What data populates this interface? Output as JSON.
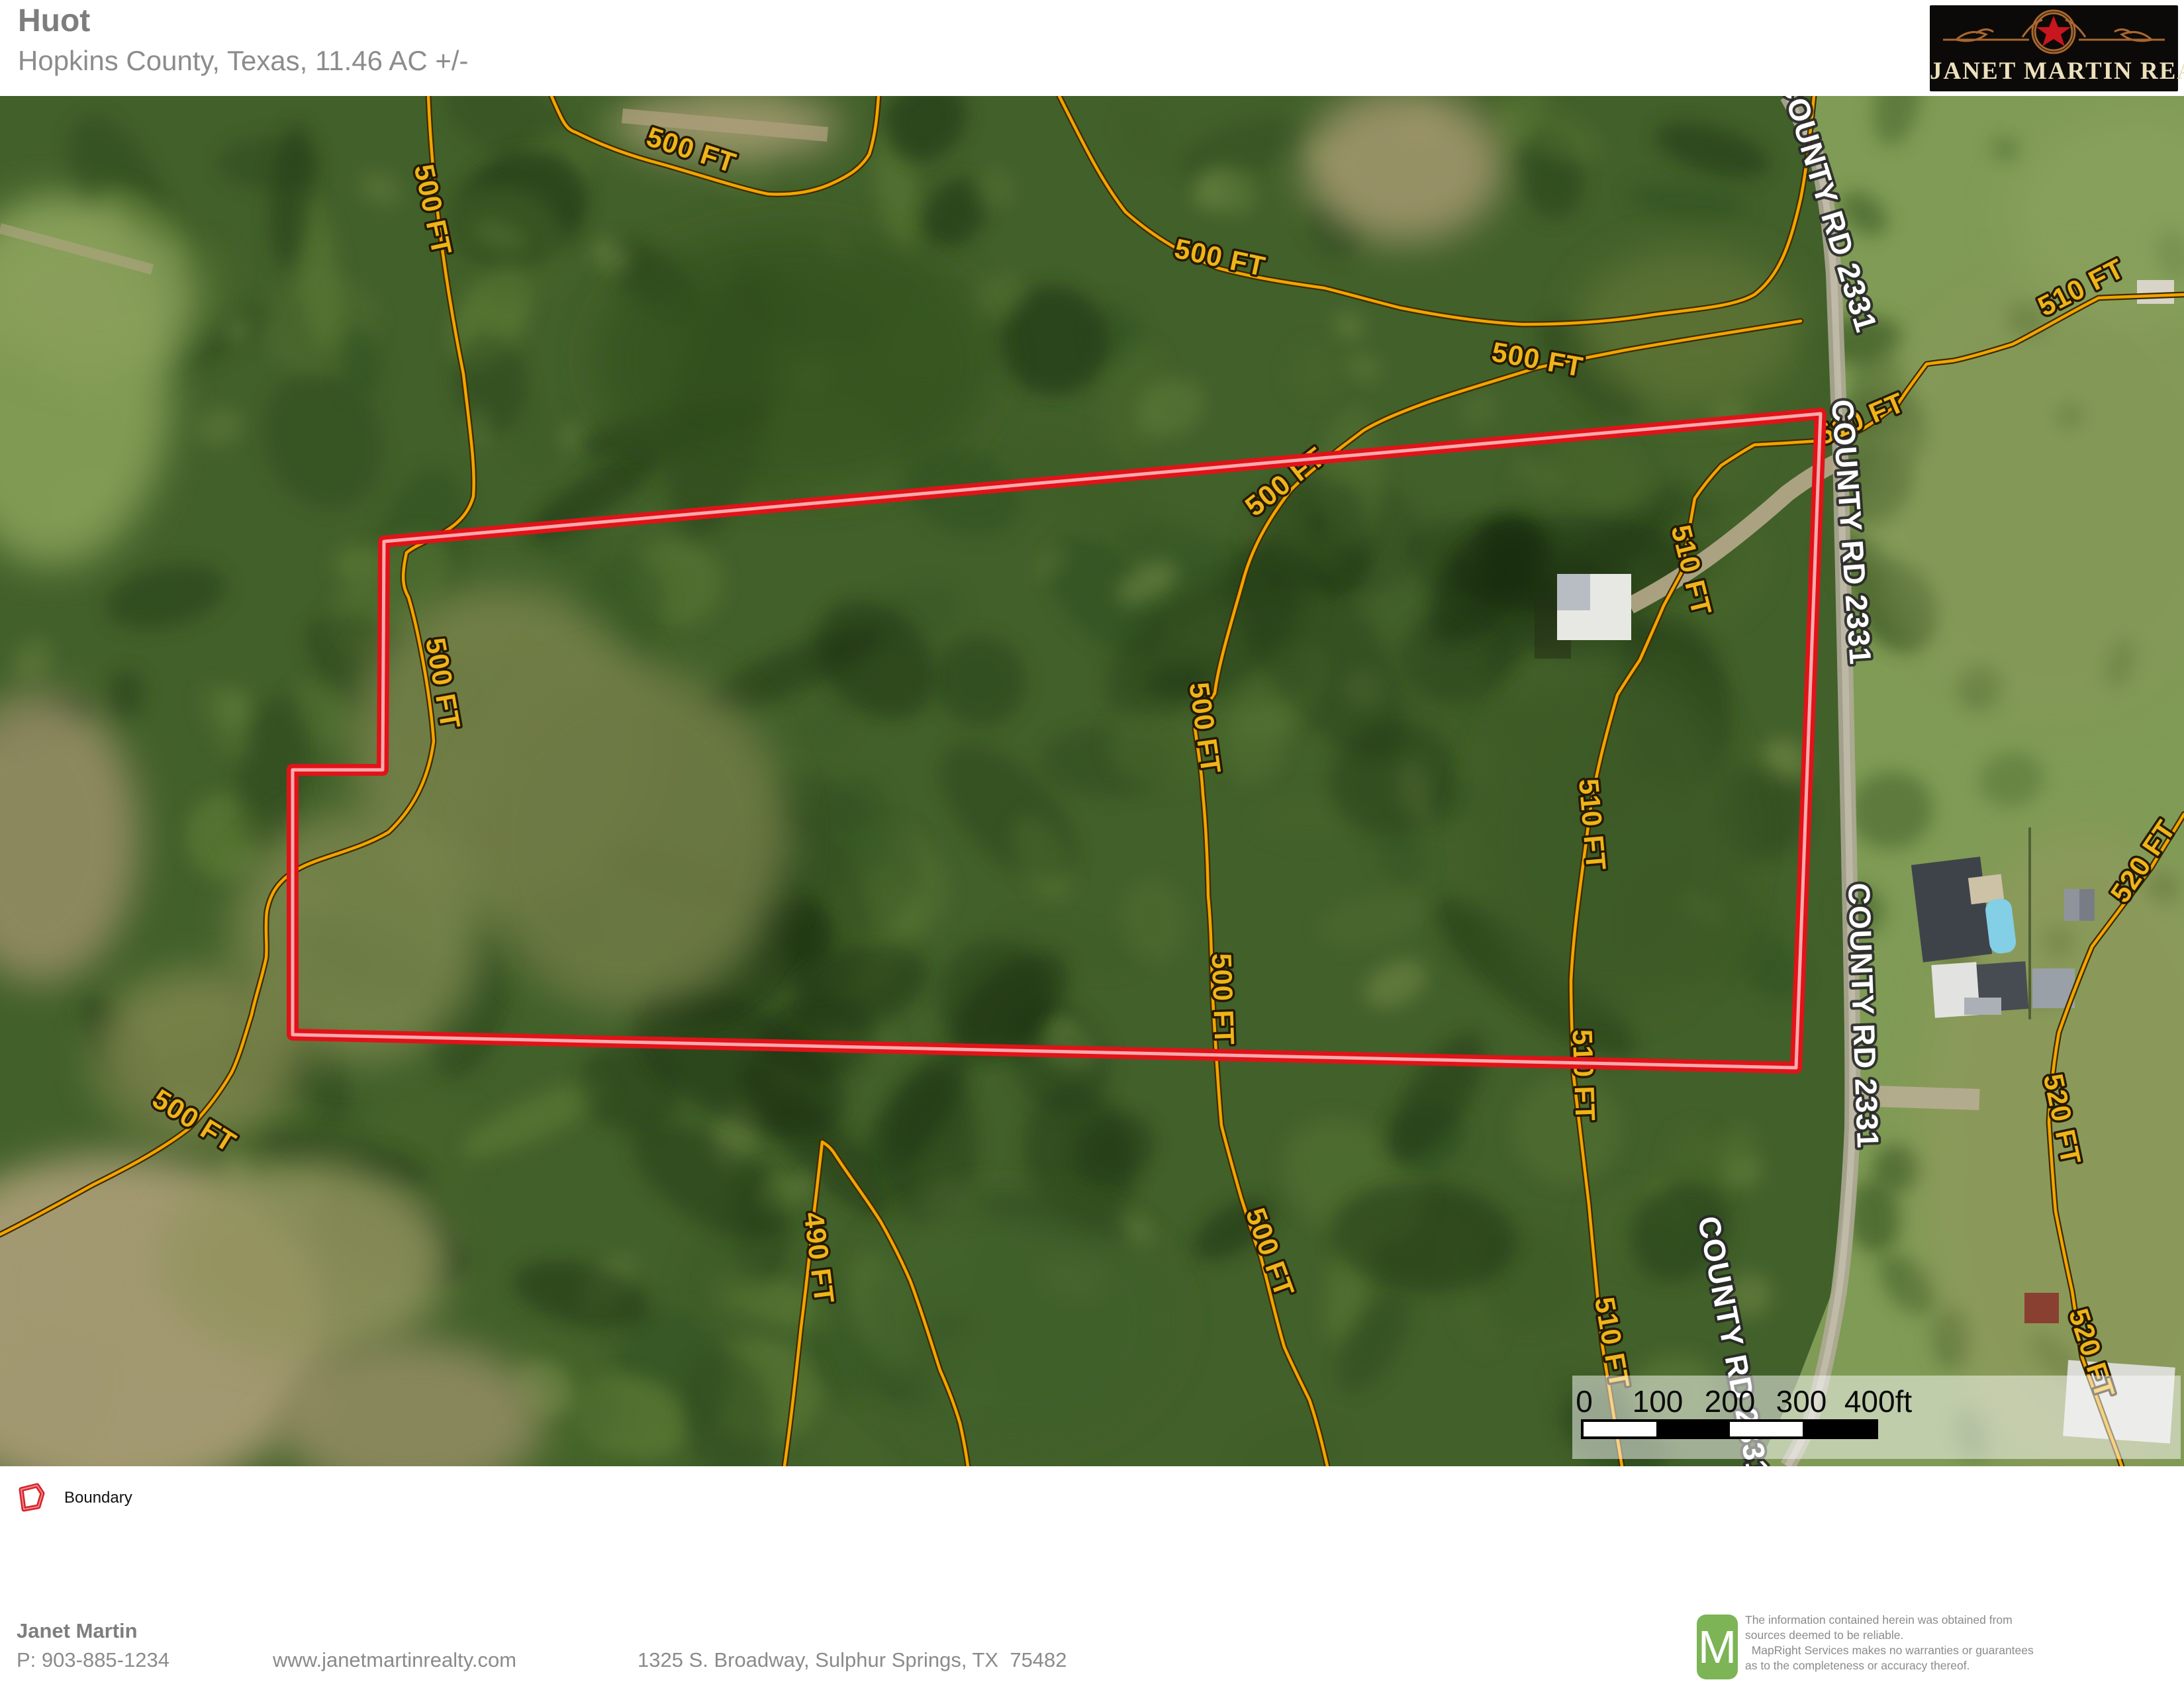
{
  "header": {
    "title": "Huot",
    "subtitle": "Hopkins County, Texas, 11.46 AC +/-"
  },
  "brand": {
    "name": "JANET MARTIN REALTY",
    "bg_color": "#0c0a08",
    "text_color": "#ece1bc",
    "star_color": "#c8151e",
    "ornament_color": "#a9672f"
  },
  "map": {
    "road_labels": [
      "COUNTY RD 2331",
      "COUNTY RD 2331",
      "COUNTY RD 2331",
      "COUNTY RD 2331"
    ],
    "contour_labels": [
      {
        "text": "500 FT"
      },
      {
        "text": "500 FT"
      },
      {
        "text": "500 FT"
      },
      {
        "text": "500 FT"
      },
      {
        "text": "500 FT"
      },
      {
        "text": "500 FT"
      },
      {
        "text": "500 FT"
      },
      {
        "text": "500 FT"
      },
      {
        "text": "500 FT"
      },
      {
        "text": "500 FT"
      },
      {
        "text": "490 FT"
      },
      {
        "text": "510 FT"
      },
      {
        "text": "510 FT"
      },
      {
        "text": "510 FT"
      },
      {
        "text": "510 FT"
      },
      {
        "text": "510 FT"
      },
      {
        "text": "510 FT"
      },
      {
        "text": "520 FT"
      },
      {
        "text": "520 FT"
      },
      {
        "text": "520 FT"
      }
    ],
    "scale": {
      "ticks": [
        "0",
        "100",
        "200",
        "300",
        "400ft"
      ]
    },
    "boundary_color": "#e01319",
    "contour_color": "#f2a400"
  },
  "legend": {
    "items": [
      {
        "label": "Boundary",
        "color": "#d8232a"
      }
    ]
  },
  "footer": {
    "agent": "Janet Martin",
    "phone": "P: 903-885-1234",
    "website": "www.janetmartinrealty.com",
    "address": "1325 S. Broadway, Sulphur Springs, TX  75482",
    "map_logo_letter": "M",
    "map_logo_color": "#7cb456",
    "disclaimer": [
      "The information contained herein was obtained from",
      "sources deemed to be reliable.",
      "  MapRight Services makes no warranties or guarantees",
      "as to the completeness or accuracy thereof."
    ]
  }
}
